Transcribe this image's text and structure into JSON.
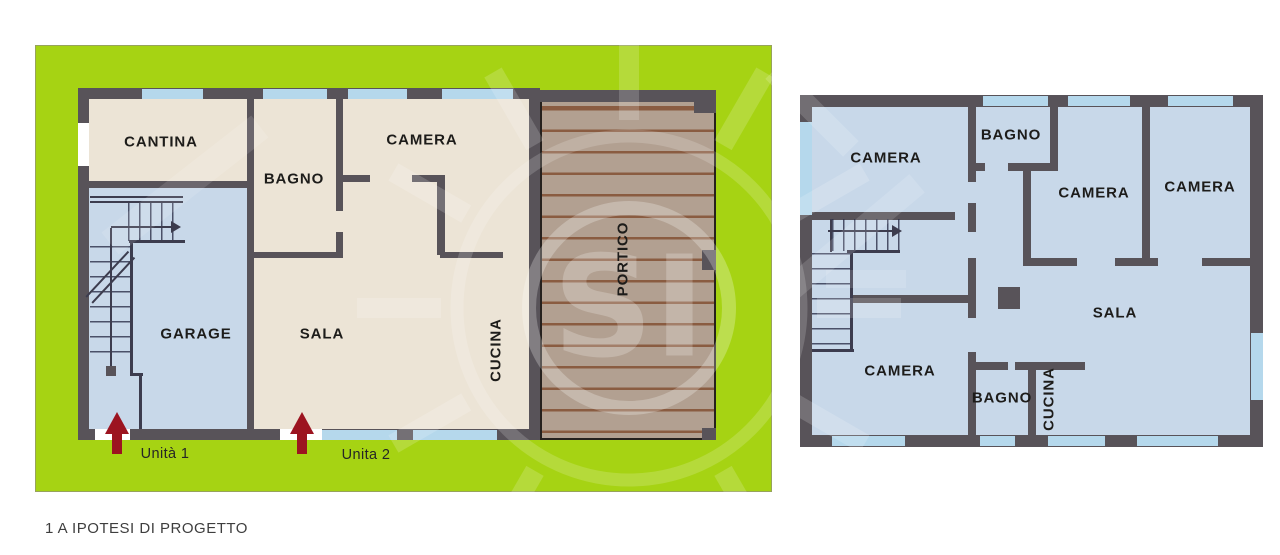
{
  "caption": "1 A IPOTESI DI PROGETTO",
  "watermark": {
    "text": "SI"
  },
  "left_plan": {
    "name": "piano terra / lotto",
    "rooms": [
      {
        "name": "cantina",
        "label": "CANTINA"
      },
      {
        "name": "bagno",
        "label": "BAGNO"
      },
      {
        "name": "camera",
        "label": "CAMERA"
      },
      {
        "name": "garage",
        "label": "GARAGE"
      },
      {
        "name": "sala",
        "label": "SALA"
      },
      {
        "name": "cucina",
        "label": "CUCINA"
      },
      {
        "name": "portico",
        "label": "PORTICO"
      }
    ],
    "units": [
      {
        "label": "Unità 1"
      },
      {
        "label": "Unita 2"
      }
    ]
  },
  "right_plan": {
    "name": "piano primo",
    "rooms": [
      {
        "name": "camera-nw",
        "label": "CAMERA"
      },
      {
        "name": "bagno-top",
        "label": "BAGNO"
      },
      {
        "name": "camera-mid",
        "label": "CAMERA"
      },
      {
        "name": "camera-ne",
        "label": "CAMERA"
      },
      {
        "name": "camera-sw",
        "label": "CAMERA"
      },
      {
        "name": "bagno-bottom",
        "label": "BAGNO"
      },
      {
        "name": "cucina",
        "label": "CUCINA"
      },
      {
        "name": "sala",
        "label": "SALA"
      }
    ]
  },
  "colors": {
    "lot_green": "#a6d313",
    "wall_gray": "#585359",
    "room_beige": "#ece4d6",
    "room_blue": "#c8d8e9",
    "window_blue": "#b5d8ec",
    "portico_base": "#b2a091",
    "portico_stripe": "#8a5c41",
    "entrance_arrow_red": "#9c1420",
    "label_text": "#1d1c1a"
  }
}
